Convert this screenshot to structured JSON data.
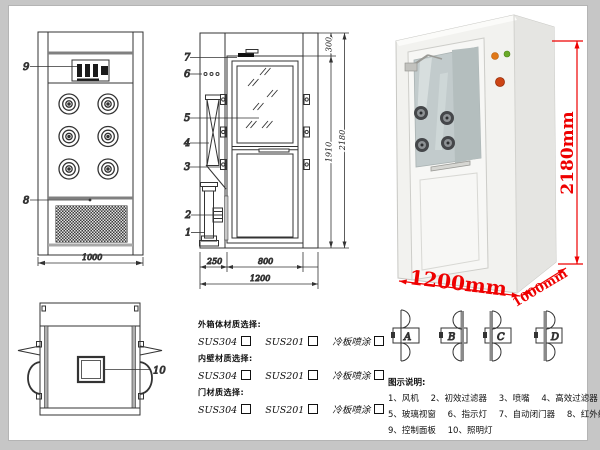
{
  "drawing": {
    "front_view": {
      "callout_9": "9",
      "callout_8": "8",
      "dim_width": "1000"
    },
    "side_view": {
      "callout_7": "7",
      "callout_6": "6",
      "callout_5": "5",
      "callout_4": "4",
      "callout_3": "3",
      "callout_2": "2",
      "callout_1": "1",
      "dim_top": "300",
      "dim_door_height": "1910",
      "dim_total_height": "2180",
      "dim_left": "250",
      "dim_door_width": "800",
      "dim_total_width": "1200"
    },
    "top_view": {
      "callout_10": "10"
    }
  },
  "photo": {
    "dim_height": "2180mm",
    "dim_width": "1200mm",
    "dim_depth": "1000mm",
    "dim_color": "#ee0000"
  },
  "materials": {
    "groups": [
      {
        "title": "外箱体材质选择:",
        "opt1": "SUS304",
        "opt2": "SUS201",
        "opt3": "冷板喷涂"
      },
      {
        "title": "内壁材质选择:",
        "opt1": "SUS304",
        "opt2": "SUS201",
        "opt3": "冷板喷涂"
      },
      {
        "title": "门材质选择:",
        "opt1": "SUS304",
        "opt2": "SUS201",
        "opt3": "冷板喷涂"
      }
    ]
  },
  "door_options": {
    "a": "A",
    "b": "B",
    "c": "C",
    "d": "D"
  },
  "legend": {
    "title": "图示说明:",
    "row1": [
      "1、风机",
      "2、初效过滤器",
      "3、喷嘴",
      "4、高效过滤器"
    ],
    "row2": [
      "5、玻璃视窗",
      "6、指示灯",
      "7、自动闭门器",
      "8、红外线感应器"
    ],
    "row3": [
      "9、控制面板",
      "10、照明灯"
    ]
  }
}
